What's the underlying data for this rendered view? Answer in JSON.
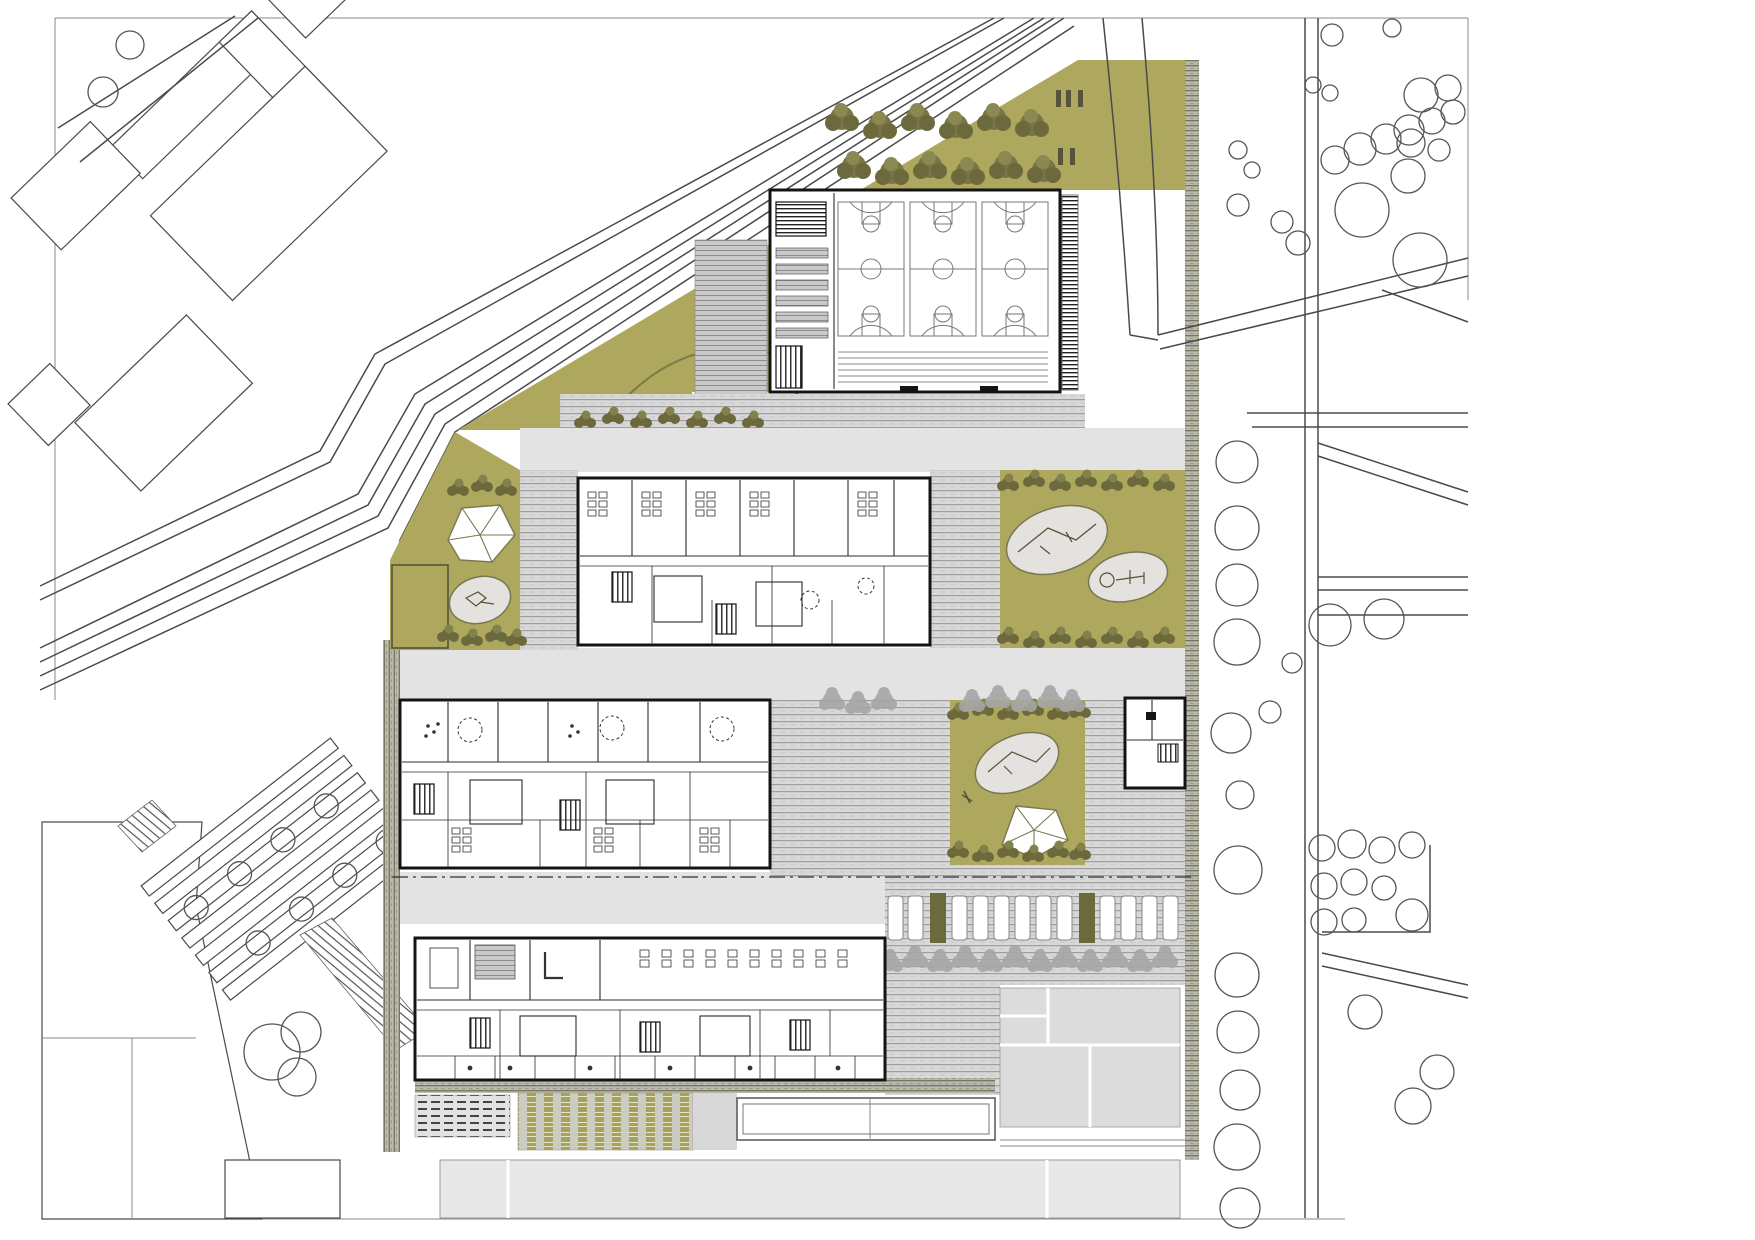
{
  "meta": {
    "drawing_type": "architectural site plan (ground-floor plan of a school campus)",
    "visible_text": "none"
  },
  "palette": {
    "background": "#ffffff",
    "lawn": "#ada85d",
    "shrub_dark": "#6c6a3c",
    "shrub_light": "#83814b",
    "tree_gray": "#a6a6a6",
    "plaza": "#e3e3e3",
    "paving_bg": "#d8d8d8",
    "paving_line": "#9f9f9f",
    "context_fill": "#e8e8e8",
    "panel_gray": "#dcdcdc",
    "wall": "#141414",
    "court_line": "#777777",
    "road_line": "#4a4a4a",
    "oval_fill": "#e3e2df",
    "stall_fill": "#ffffff",
    "edge_band": "#b9b9ad",
    "garden_band": "#a7a258"
  },
  "site": {
    "sports_hall": {
      "basketball_courts": 3,
      "seat_rows": 6,
      "bleacher_rows": 6
    },
    "school_buildings": 3,
    "pavilion_buildings": 1,
    "playground_ovals": 4,
    "climbing_structures": 2,
    "parking": {
      "stalls": 12,
      "tree_row": 12
    },
    "allotment_garden_rows": 7,
    "allotment_trees": 8,
    "context_tree_trio": 3
  }
}
